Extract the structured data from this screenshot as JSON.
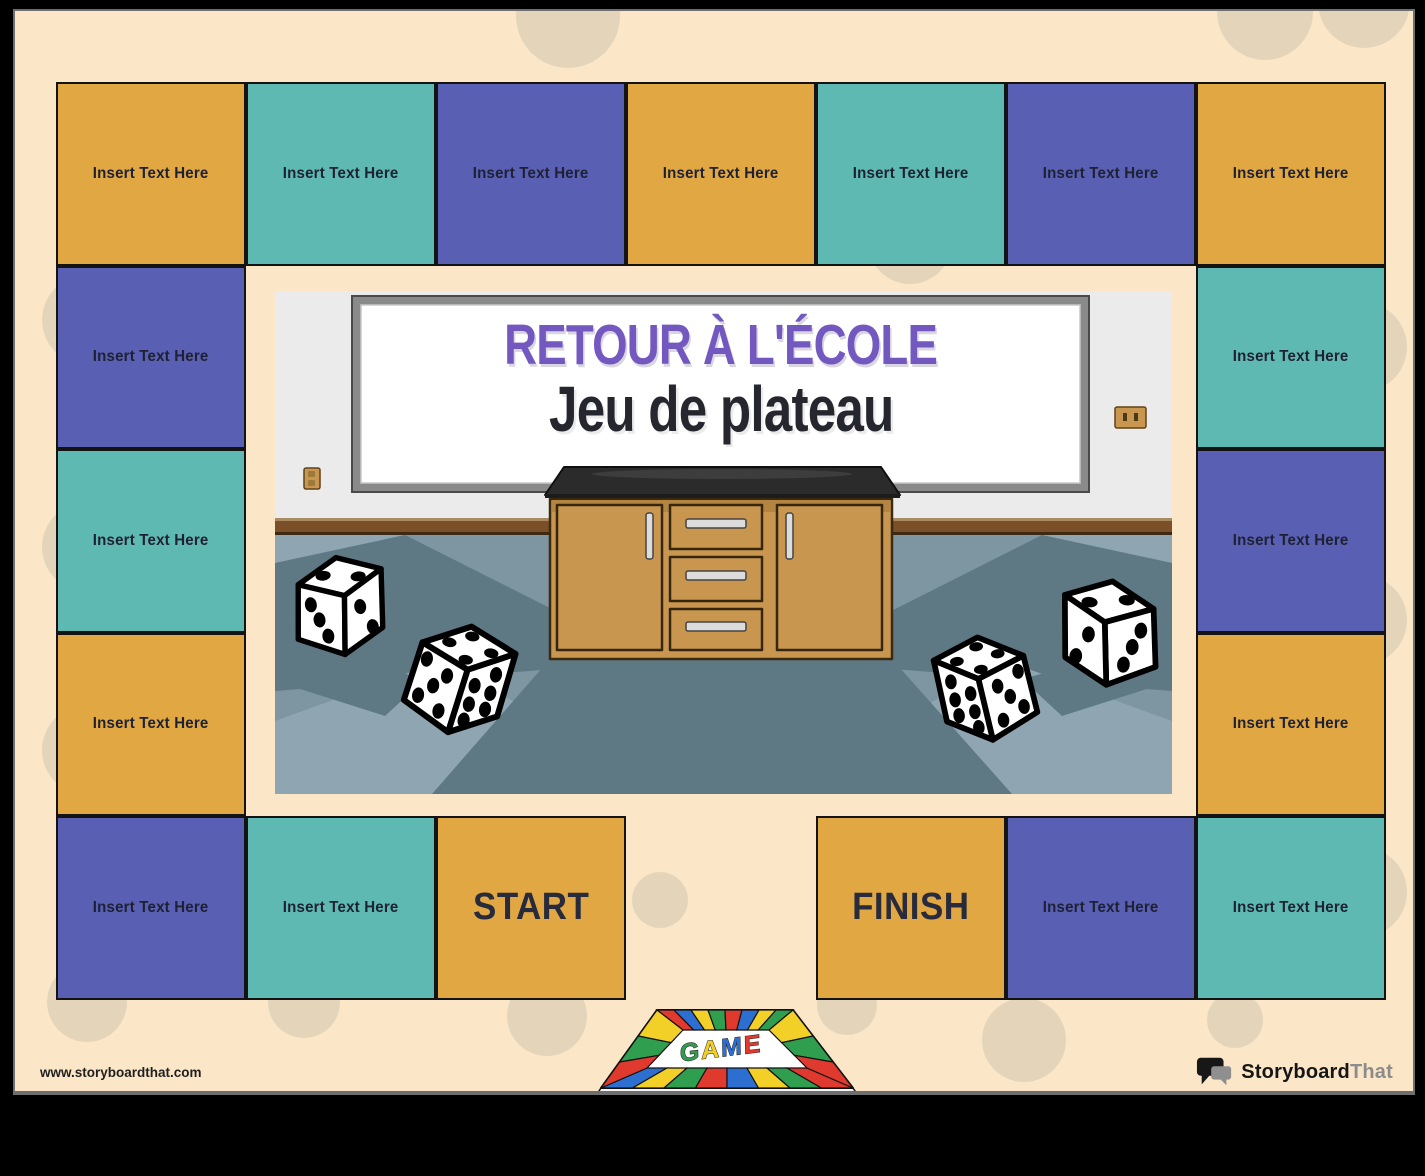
{
  "title": {
    "line1": "RETOUR À L'ÉCOLE",
    "line2": "Jeu de plateau",
    "line1_color": "#7358BF",
    "line2_color": "#26262E"
  },
  "branding": {
    "website_url": "www.storyboardthat.com",
    "logo_text_primary": "Storyboard",
    "logo_text_secondary": "That"
  },
  "board": {
    "default_cell_label": "Insert Text Here",
    "start_label": "START",
    "finish_label": "FINISH",
    "colors": {
      "gold": "#E0A743",
      "teal": "#5FB9B3",
      "purple": "#5960B4",
      "label_text": "#1E2133"
    },
    "grid": {
      "origin_x": 41,
      "origin_y": 71,
      "cell_w": 190,
      "cell_h": 183.5,
      "cols": 7,
      "rows": 5
    },
    "cells": [
      {
        "col": 0,
        "row": 0,
        "color": "gold",
        "label": "Insert Text Here"
      },
      {
        "col": 1,
        "row": 0,
        "color": "teal",
        "label": "Insert Text Here"
      },
      {
        "col": 2,
        "row": 0,
        "color": "purple",
        "label": "Insert Text Here"
      },
      {
        "col": 3,
        "row": 0,
        "color": "gold",
        "label": "Insert Text Here"
      },
      {
        "col": 4,
        "row": 0,
        "color": "teal",
        "label": "Insert Text Here"
      },
      {
        "col": 5,
        "row": 0,
        "color": "purple",
        "label": "Insert Text Here"
      },
      {
        "col": 6,
        "row": 0,
        "color": "gold",
        "label": "Insert Text Here"
      },
      {
        "col": 0,
        "row": 1,
        "color": "purple",
        "label": "Insert Text Here"
      },
      {
        "col": 6,
        "row": 1,
        "color": "teal",
        "label": "Insert Text Here"
      },
      {
        "col": 0,
        "row": 2,
        "color": "teal",
        "label": "Insert Text Here"
      },
      {
        "col": 6,
        "row": 2,
        "color": "purple",
        "label": "Insert Text Here"
      },
      {
        "col": 0,
        "row": 3,
        "color": "gold",
        "label": "Insert Text Here"
      },
      {
        "col": 6,
        "row": 3,
        "color": "gold",
        "label": "Insert Text Here"
      },
      {
        "col": 0,
        "row": 4,
        "color": "purple",
        "label": "Insert Text Here"
      },
      {
        "col": 1,
        "row": 4,
        "color": "teal",
        "label": "Insert Text Here"
      },
      {
        "col": 2,
        "row": 4,
        "color": "gold",
        "label": "START",
        "big": true,
        "kind": "start"
      },
      {
        "col": 4,
        "row": 4,
        "color": "gold",
        "label": "FINISH",
        "big": true,
        "kind": "finish"
      },
      {
        "col": 5,
        "row": 4,
        "color": "purple",
        "label": "Insert Text Here"
      },
      {
        "col": 6,
        "row": 4,
        "color": "teal",
        "label": "Insert Text Here"
      }
    ]
  },
  "background_dots": [
    {
      "x": 553,
      "y": 5,
      "r": 52
    },
    {
      "x": 1250,
      "y": 1,
      "r": 48
    },
    {
      "x": 1349,
      "y": -9,
      "r": 46
    },
    {
      "x": 72,
      "y": 309,
      "r": 45
    },
    {
      "x": 72,
      "y": 536,
      "r": 45
    },
    {
      "x": 72,
      "y": 739,
      "r": 45
    },
    {
      "x": 72,
      "y": 991,
      "r": 40
    },
    {
      "x": 895,
      "y": 231,
      "r": 42
    },
    {
      "x": 645,
      "y": 889,
      "r": 28
    },
    {
      "x": 532,
      "y": 1005,
      "r": 40
    },
    {
      "x": 289,
      "y": 991,
      "r": 36
    },
    {
      "x": 1009,
      "y": 1029,
      "r": 42
    },
    {
      "x": 1220,
      "y": 1009,
      "r": 28
    },
    {
      "x": 832,
      "y": 994,
      "r": 30
    },
    {
      "x": 1347,
      "y": 336,
      "r": 45
    },
    {
      "x": 1347,
      "y": 609,
      "r": 45
    },
    {
      "x": 1347,
      "y": 881,
      "r": 45
    }
  ],
  "scene": {
    "wall": "#EBEBEB",
    "whiteboard_frame": "#8A8A8A",
    "whiteboard_surface": "#FFFFFF",
    "rail": "#7B4F28",
    "rail_shadow": "#3E2912",
    "floor_base": "#7E95A2",
    "floor_dark": "#5E7884",
    "floor_light": "#8FA6B2",
    "cabinet_wood": "#C9964F",
    "cabinet_outline": "#3A2B10",
    "counter_top": "#2B2B2B",
    "handle": "#DCDCDC",
    "die_face": "#FFFFFF",
    "die_pip": "#000000"
  },
  "game_board_icon": {
    "label": "GAME",
    "surface": "#FFFFFF",
    "cell_colors": [
      "#E03A2F",
      "#2D6FD1",
      "#F2D028",
      "#2F9E4F"
    ],
    "letter_colors": [
      "#2F9E4F",
      "#F2D028",
      "#2D6FD1",
      "#E03A2F"
    ]
  }
}
